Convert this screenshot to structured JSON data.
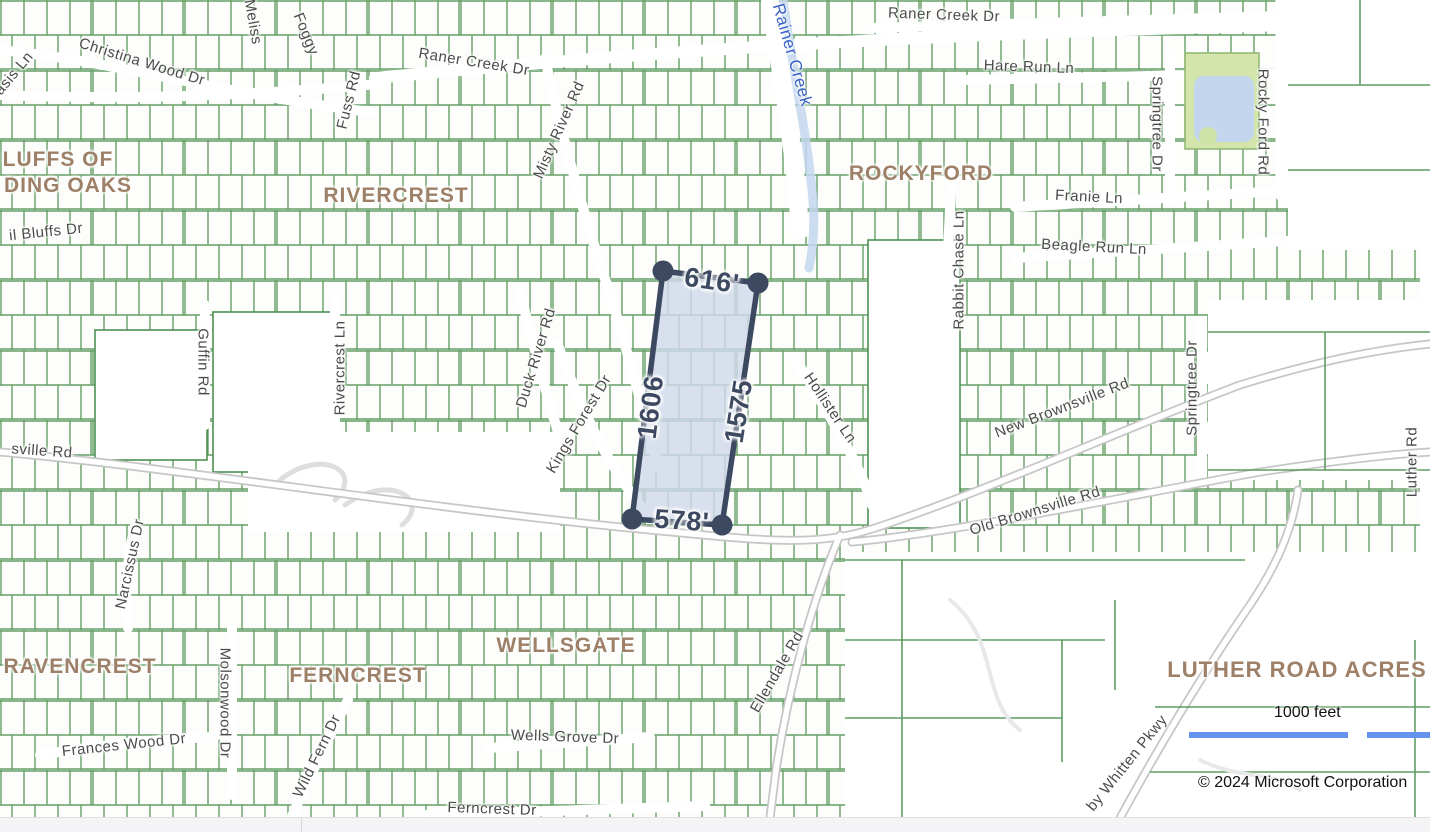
{
  "map": {
    "colors": {
      "background": "#fdfdfb",
      "parcel_line": "#4e9152",
      "road_gray": "#c6c6c6",
      "water": "#c3d6ee",
      "park": "#d3e5ab",
      "neighborhood_text": "#9d8067",
      "street_text": "#4b4b4b",
      "creek_text": "#3b62c5",
      "measurement": "#3c4960",
      "scale_bar": "#6592ef"
    },
    "neighborhoods": [
      {
        "text": "LUFFS OF",
        "x": 58,
        "y": 160
      },
      {
        "text": "DING OAKS",
        "x": 68,
        "y": 186
      },
      {
        "text": "RIVERCREST",
        "x": 396,
        "y": 196
      },
      {
        "text": "ROCKYFORD",
        "x": 921,
        "y": 174
      },
      {
        "text": "RAVENCREST",
        "x": 80,
        "y": 667
      },
      {
        "text": "FERNCREST",
        "x": 358,
        "y": 676
      },
      {
        "text": "WELLSGATE",
        "x": 566,
        "y": 646
      },
      {
        "text": "LUTHER ROAD ACRES",
        "x": 1297,
        "y": 670,
        "big": true
      }
    ],
    "streets": [
      {
        "text": "Oasis Ln",
        "x": 10,
        "y": 78,
        "rot": -50
      },
      {
        "text": "Christina Wood Dr",
        "x": 142,
        "y": 62,
        "rot": 17
      },
      {
        "text": "Meliss",
        "x": 253,
        "y": 22,
        "rot": 80
      },
      {
        "text": "Foggy",
        "x": 306,
        "y": 34,
        "rot": 68
      },
      {
        "text": "Fuss Rd",
        "x": 349,
        "y": 100,
        "rot": -76
      },
      {
        "text": "Raner Creek Dr",
        "x": 474,
        "y": 62,
        "rot": 9
      },
      {
        "text": "Misty River Rd",
        "x": 559,
        "y": 130,
        "rot": -66
      },
      {
        "text": "Raner Creek Dr",
        "x": 944,
        "y": 15,
        "rot": 2
      },
      {
        "text": "Hare Run Ln",
        "x": 1029,
        "y": 67,
        "rot": 2
      },
      {
        "text": "Springtree Dr",
        "x": 1157,
        "y": 124,
        "rot": 90
      },
      {
        "text": "Rocky Ford Rd",
        "x": 1263,
        "y": 122,
        "rot": 90
      },
      {
        "text": "Franie Ln",
        "x": 1089,
        "y": 197,
        "rot": 3
      },
      {
        "text": "Beagle Run Ln",
        "x": 1094,
        "y": 247,
        "rot": 3
      },
      {
        "text": "Rabbit Chase Ln",
        "x": 959,
        "y": 270,
        "rot": -90
      },
      {
        "text": "il Bluffs Dr",
        "x": 46,
        "y": 232,
        "rot": -6
      },
      {
        "text": "Guffin Rd",
        "x": 203,
        "y": 362,
        "rot": 90
      },
      {
        "text": "Rivercrest Ln",
        "x": 340,
        "y": 368,
        "rot": -90
      },
      {
        "text": "Duck River Rd",
        "x": 536,
        "y": 358,
        "rot": -73
      },
      {
        "text": "Kings Forest Dr",
        "x": 579,
        "y": 424,
        "rot": -59
      },
      {
        "text": "sville Rd",
        "x": 42,
        "y": 451,
        "rot": 4
      },
      {
        "text": "Hollister Ln",
        "x": 830,
        "y": 408,
        "rot": 56
      },
      {
        "text": "New Brownsville Rd",
        "x": 1062,
        "y": 408,
        "rot": -21
      },
      {
        "text": "Springtree Dr",
        "x": 1192,
        "y": 388,
        "rot": -90
      },
      {
        "text": "Luther Rd",
        "x": 1412,
        "y": 462,
        "rot": -90
      },
      {
        "text": "Old Brownsville Rd",
        "x": 1035,
        "y": 511,
        "rot": -17
      },
      {
        "text": "Narcissus Dr",
        "x": 130,
        "y": 564,
        "rot": -78
      },
      {
        "text": "Molsonwood Dr",
        "x": 225,
        "y": 703,
        "rot": 90
      },
      {
        "text": "Wild Fern Dr",
        "x": 317,
        "y": 756,
        "rot": -64
      },
      {
        "text": "Frances Wood Dr",
        "x": 124,
        "y": 745,
        "rot": -6
      },
      {
        "text": "Wells Grove Dr",
        "x": 565,
        "y": 737,
        "rot": 2
      },
      {
        "text": "Ferncrest Dr",
        "x": 492,
        "y": 809,
        "rot": 2
      },
      {
        "text": "Ellendale Rd",
        "x": 777,
        "y": 672,
        "rot": -60
      },
      {
        "text": "by Whitten Pkwy",
        "x": 1127,
        "y": 763,
        "rot": -51
      }
    ],
    "creek_labels": [
      {
        "text": "Rainer Creek",
        "x": 792,
        "y": 55,
        "rot": 74
      }
    ]
  },
  "measurement": {
    "vertices": [
      [
        663,
        271
      ],
      [
        758,
        283
      ],
      [
        722,
        525
      ],
      [
        632,
        519
      ]
    ],
    "labels": [
      {
        "text": "616'",
        "x": 712,
        "y": 281,
        "rot": 8
      },
      {
        "text": "1606",
        "x": 651,
        "y": 407,
        "rot": -83
      },
      {
        "text": "1575",
        "x": 739,
        "y": 411,
        "rot": -81
      },
      {
        "text": "578'",
        "x": 682,
        "y": 521,
        "rot": 4
      }
    ]
  },
  "scale": {
    "label": "1000 feet"
  },
  "attribution": {
    "text": "© 2024 Microsoft Corporation"
  }
}
